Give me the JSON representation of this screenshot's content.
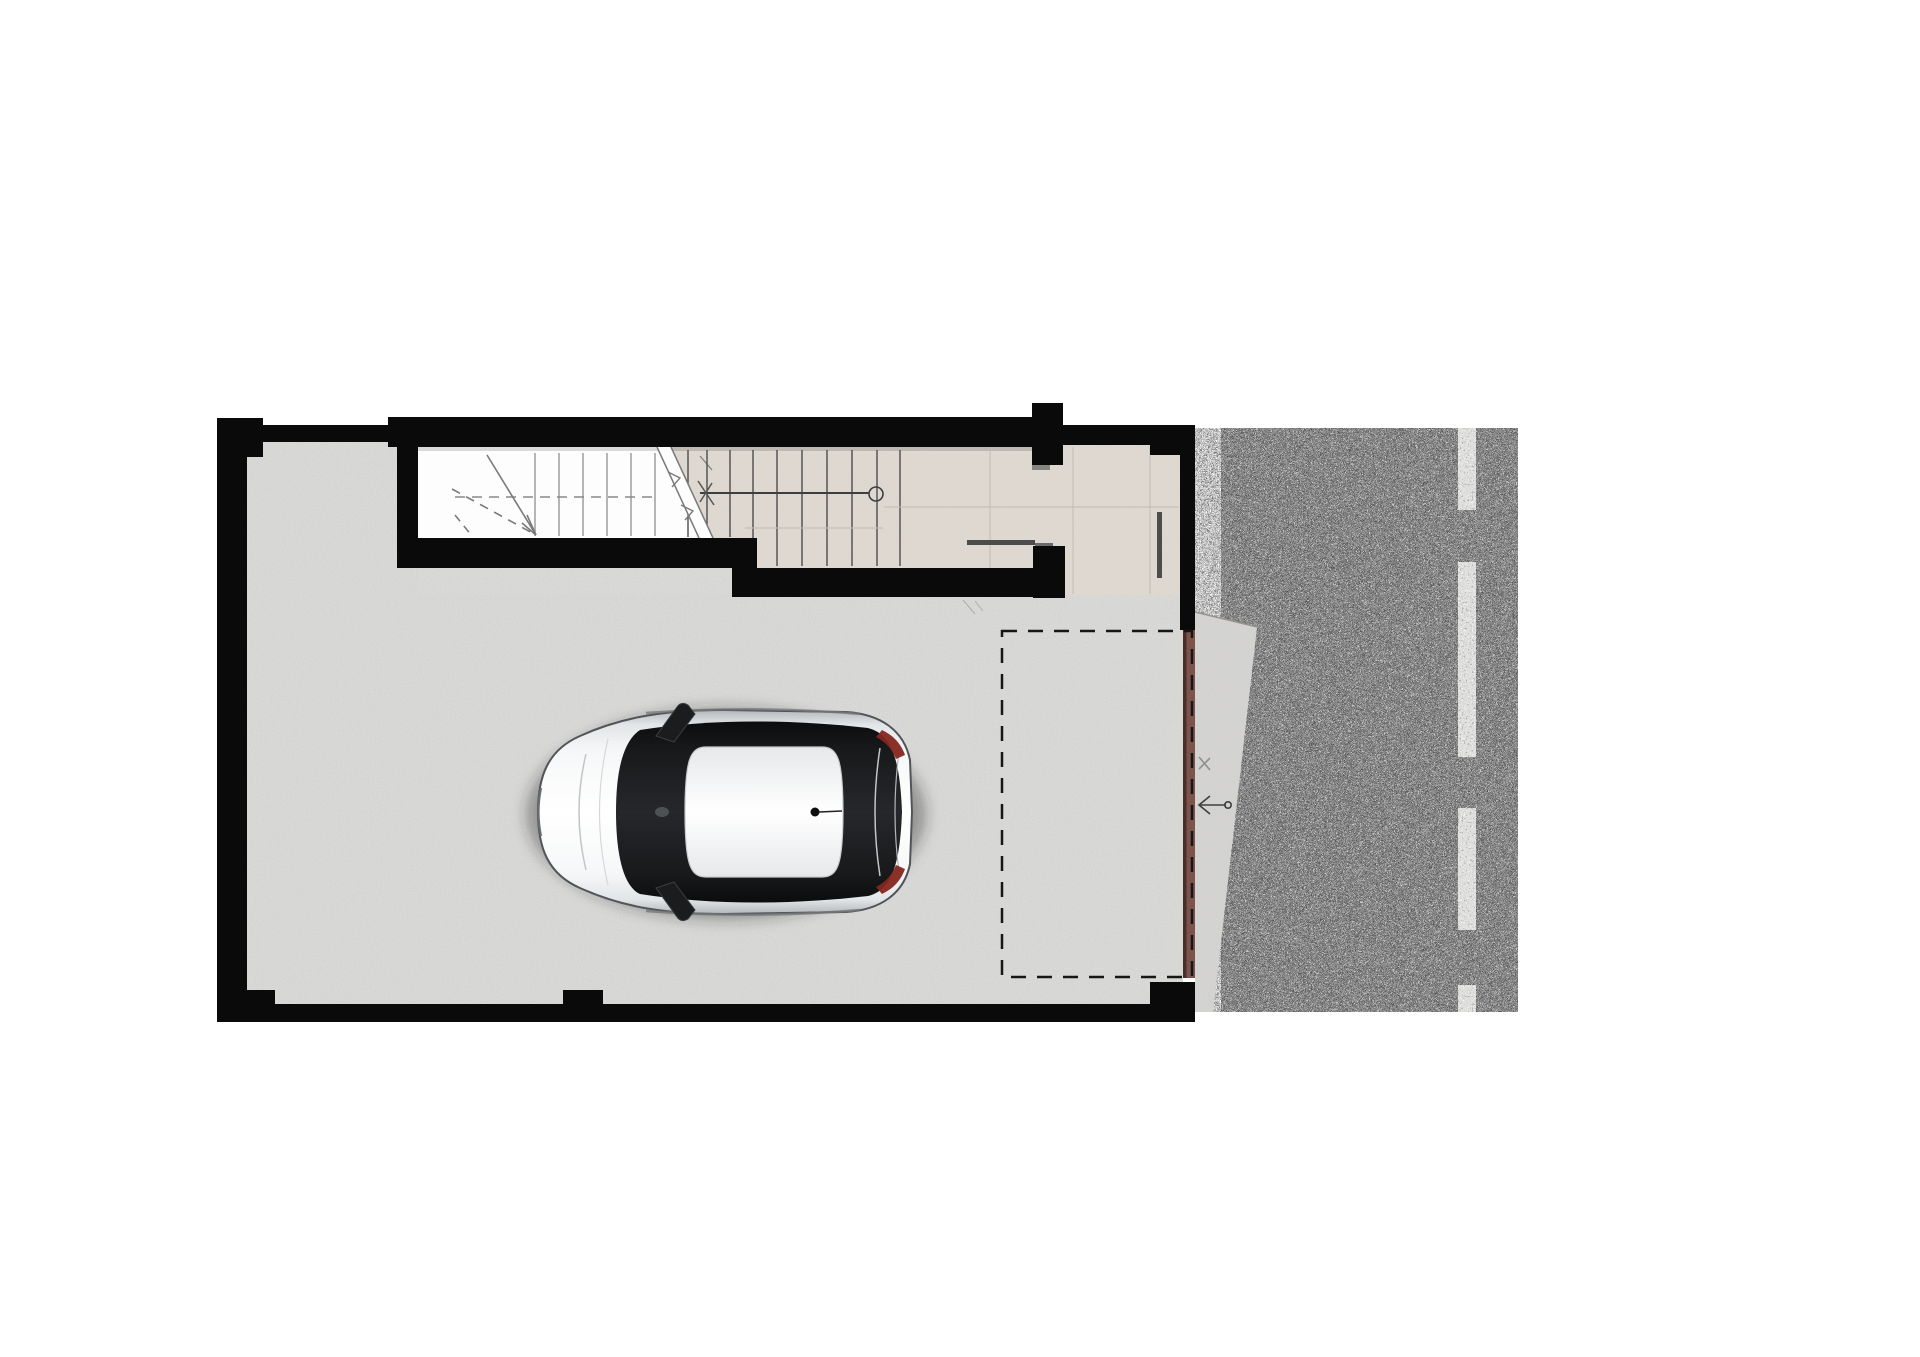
{
  "plan_type": "basement-garage-floor-plan",
  "regions": {
    "garage": "garage-floor",
    "stairwell": "stairwell",
    "landing": "stair-landing",
    "entry": "entry-hall",
    "parking": "parking-space-outline",
    "driveway": "driveway-apron",
    "road": "asphalt-road"
  },
  "colors": {
    "page_bg": "#ffffff",
    "wall": "#0a0a0a",
    "garage_floor": "#bcbbb9",
    "stair_white": "#fdfdfd",
    "landing_beige": "#ded7ce",
    "tread": "#4c4c4c",
    "tread_light": "#a3a3a3",
    "rail": "#3e3e3e",
    "seam": "#c3bcb3",
    "break_line": "#7a7a7a",
    "asphalt_base": "#343434",
    "gravel_base": "#c9c9c9",
    "lane_paint": "#e9e9e7",
    "door_brown": "#7d544c",
    "door_edge": "#4a2e29",
    "apron": "#c9c8c5",
    "dash_outline": "#161616",
    "arrow": "#3f3f3f",
    "threshold": "#4c4c4c",
    "threshold_step": "#6a6a6a",
    "pilaster_shadow": "#87857f",
    "wall_shadow": "rgba(0,0,0,0.14)"
  },
  "plan": {
    "walls": [
      {
        "name": "wall-left",
        "x": 217,
        "y": 418,
        "w": 30,
        "h": 604
      },
      {
        "name": "wall-corner-top-left",
        "x": 217,
        "y": 418,
        "w": 46,
        "h": 39
      },
      {
        "name": "wall-top-thin",
        "x": 263,
        "y": 425,
        "w": 125,
        "h": 17
      },
      {
        "name": "wall-top-main",
        "x": 388,
        "y": 417,
        "w": 644,
        "h": 30
      },
      {
        "name": "wall-stair-jamb",
        "x": 397,
        "y": 447,
        "w": 21,
        "h": 121
      },
      {
        "name": "wall-stair-bottom-upper",
        "x": 397,
        "y": 538,
        "w": 360,
        "h": 30
      },
      {
        "name": "wall-stair-bottom-lower",
        "x": 732,
        "y": 568,
        "w": 303,
        "h": 29
      },
      {
        "name": "wall-entry-pier",
        "x": 1033,
        "y": 546,
        "w": 32,
        "h": 52
      },
      {
        "name": "wall-pilaster-top",
        "x": 1032,
        "y": 403,
        "w": 31,
        "h": 62
      },
      {
        "name": "wall-entry-top",
        "x": 1063,
        "y": 425,
        "w": 132,
        "h": 20
      },
      {
        "name": "wall-entry-notch",
        "x": 1150,
        "y": 445,
        "w": 43,
        "h": 10
      },
      {
        "name": "wall-right",
        "x": 1180,
        "y": 425,
        "w": 15,
        "h": 205
      },
      {
        "name": "wall-bottom",
        "x": 217,
        "y": 1004,
        "w": 978,
        "h": 18
      },
      {
        "name": "wall-bottom-right-block",
        "x": 1150,
        "y": 982,
        "w": 45,
        "h": 40
      },
      {
        "name": "wall-bottom-notch-1",
        "x": 245,
        "y": 990,
        "w": 30,
        "h": 14
      },
      {
        "name": "wall-bottom-notch-2",
        "x": 563,
        "y": 990,
        "w": 40,
        "h": 14
      }
    ],
    "stair": {
      "tread_groups": [
        {
          "name": "upper-flight-treads",
          "xs": [
            535,
            559,
            583,
            607,
            631,
            655
          ],
          "y1": 453,
          "y2": 536,
          "color_key": "tread_light",
          "w": 1.6
        },
        {
          "name": "mid-flight-treads",
          "xs": [
            688,
            707,
            730
          ],
          "y1": 450,
          "y2": 537,
          "color_key": "tread",
          "w": 1.4
        },
        {
          "name": "lower-flight-treads",
          "xs": [
            753,
            777,
            802,
            827,
            852,
            877,
            900
          ],
          "y1": 450,
          "y2": 566,
          "color_key": "tread",
          "w": 1.4
        }
      ],
      "rail": {
        "x1": 700,
        "y1": 493,
        "x2": 869,
        "y2": 493
      },
      "newel": {
        "cx": 876,
        "cy": 494,
        "r": 7
      }
    },
    "seams": {
      "vertical": [
        {
          "x": 990,
          "y1": 450,
          "y2": 568
        },
        {
          "x": 1073,
          "y1": 447,
          "y2": 594
        },
        {
          "x": 1150,
          "y1": 447,
          "y2": 594
        }
      ],
      "horizontal": [
        {
          "y": 507,
          "x1": 884,
          "x2": 1179
        },
        {
          "y": 528,
          "x1": 745,
          "x2": 883
        }
      ]
    },
    "garage_door": {
      "x": 1183,
      "y": 630,
      "w": 12,
      "h": 348
    },
    "parking_outline": {
      "x": 1002,
      "y": 631,
      "w": 190,
      "h": 346,
      "dash": "15 11",
      "stroke_w": 2.5
    },
    "road": {
      "gravel": {
        "x": 1195,
        "y": 428,
        "w": 32,
        "h": 584
      },
      "asphalt": {
        "x": 1221,
        "y": 428,
        "w": 297,
        "h": 584
      },
      "lane_x": 1458,
      "lane_w": 18,
      "lane_dashes": [
        [
          428,
          510
        ],
        [
          562,
          757
        ],
        [
          808,
          930
        ],
        [
          985,
          1012
        ]
      ],
      "apron_points": "1195,612 1257,627 1213,1012 1195,1012"
    },
    "car": {
      "x": 528,
      "y": 690,
      "facing": "left",
      "body": "white",
      "glass": "black"
    }
  }
}
